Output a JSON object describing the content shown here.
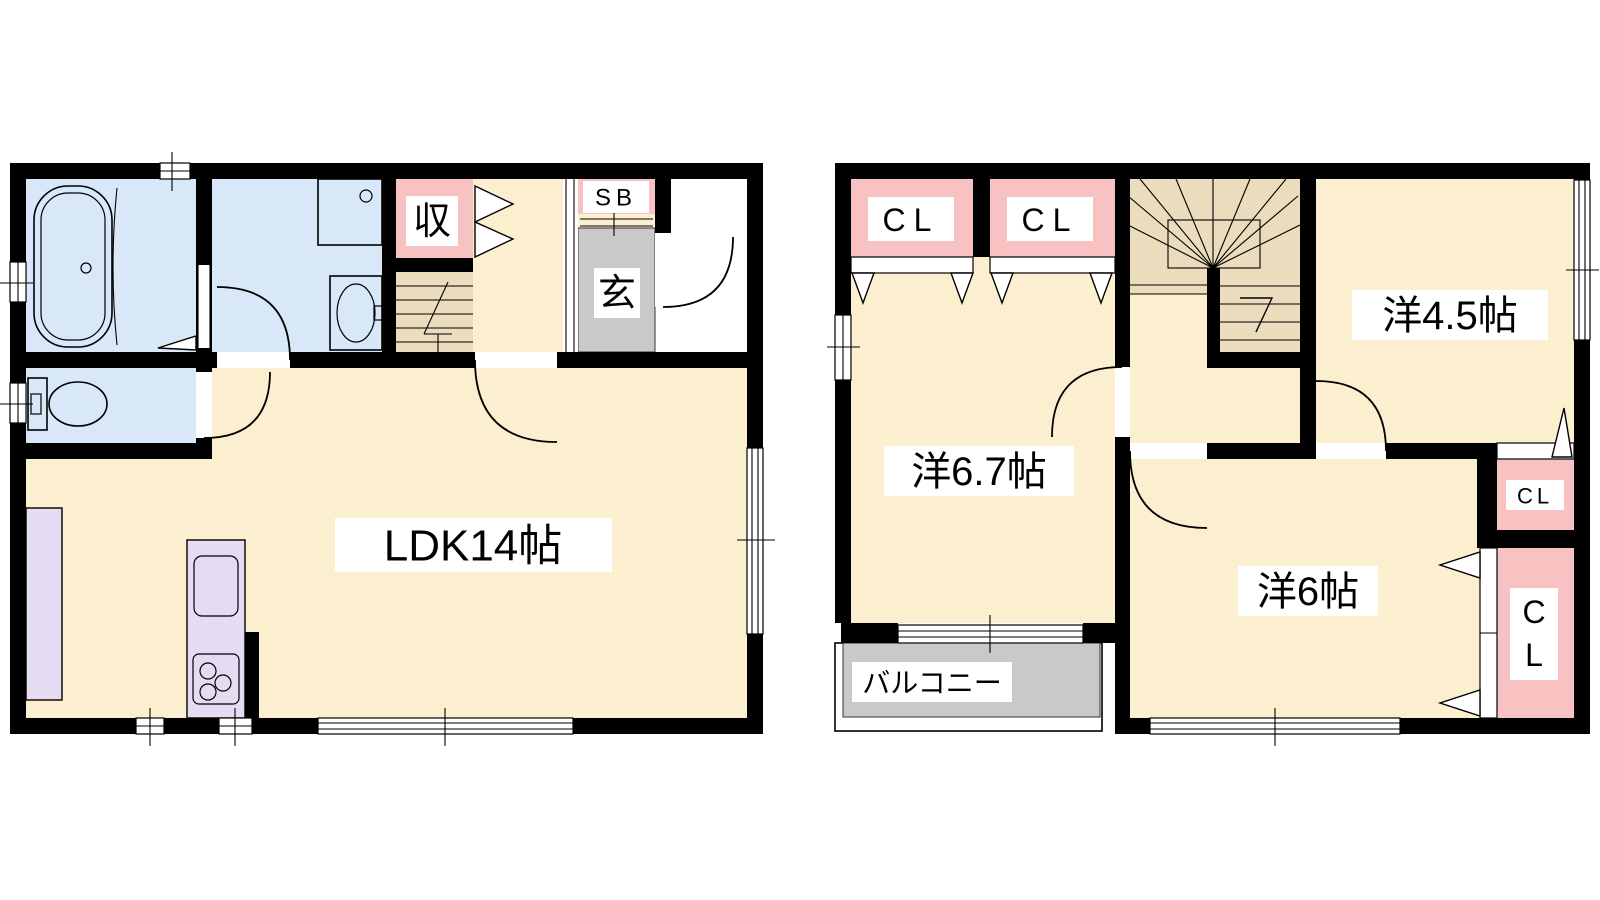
{
  "colors": {
    "wall": "#000000",
    "floor": "#FCEFD0",
    "wet_area": "#D9E8F8",
    "closet": "#F8C2C2",
    "entry_gray": "#C9C9C9",
    "balcony_gray": "#C9C9C9",
    "stairs": "#EADCBD",
    "kitchen": "#E5DBF2"
  },
  "floor1": {
    "ldk_label": "LDK14帖",
    "storage_label": "収",
    "shoebox_label": "SB",
    "entrance_label": "玄"
  },
  "floor2": {
    "room_45_label": "洋4.5帖",
    "room_67_label": "洋6.7帖",
    "room_6_label": "洋6帖",
    "closet1_label": "CL",
    "closet2_label": "CL",
    "closet_small_label": "CL",
    "closet_large_line1": "C",
    "closet_large_line2": "L",
    "balcony_label": "バルコニー"
  }
}
